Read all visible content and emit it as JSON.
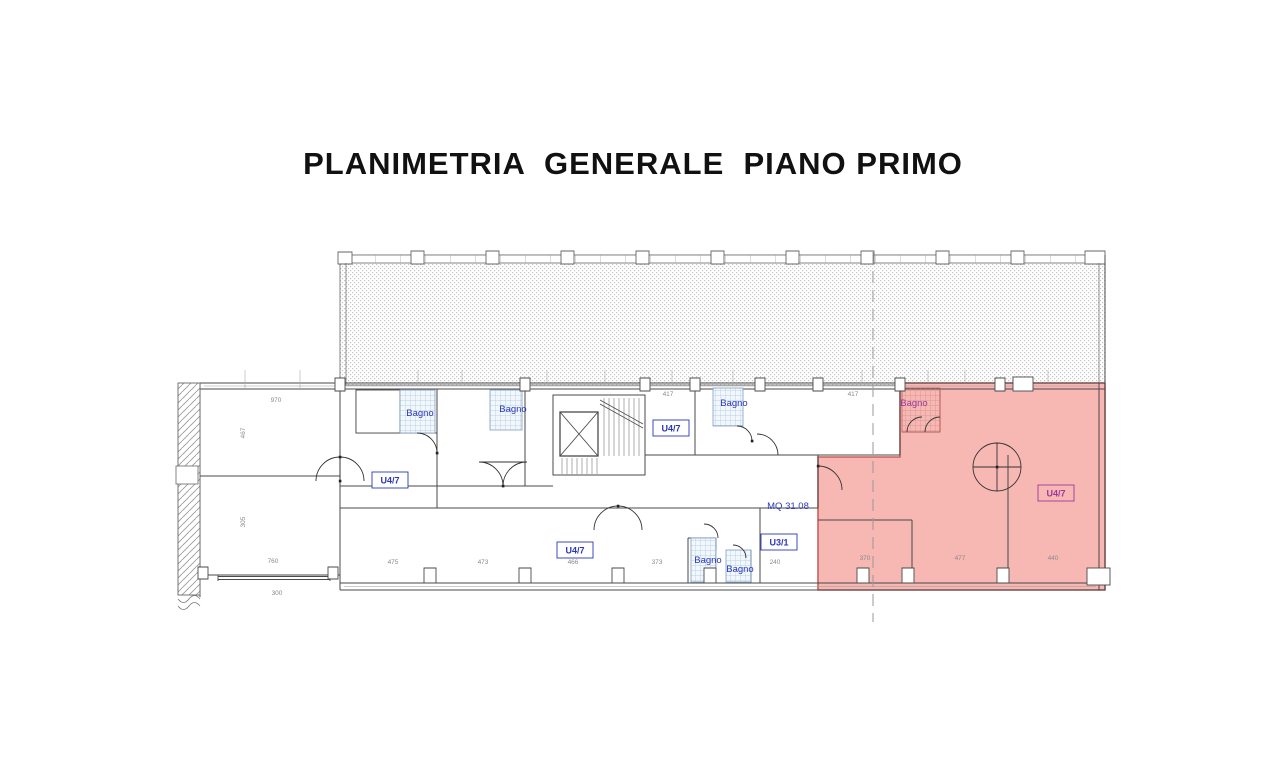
{
  "title": "PLANIMETRIA  GENERALE  PIANO PRIMO",
  "labels": {
    "bagno": "Bagno",
    "unit_u47": "U4/7",
    "unit_u31": "U3/1",
    "area_mq": "MQ 31.08"
  },
  "dimensions": [
    "970",
    "417",
    "417",
    "760",
    "475",
    "473",
    "466",
    "373",
    "240",
    "370",
    "477",
    "440",
    "467",
    "305",
    "300"
  ],
  "colors": {
    "highlight_fill": "#f7b7b3",
    "highlight_border": "#c9605b",
    "label_blue": "#2b38b5",
    "label_purple": "#9b3a9b",
    "line": "#4a4a4a",
    "dim_gray": "#8a8a8a",
    "hatch_dot": "#c4c4c4",
    "tile_blue": "#a8c4e0"
  }
}
